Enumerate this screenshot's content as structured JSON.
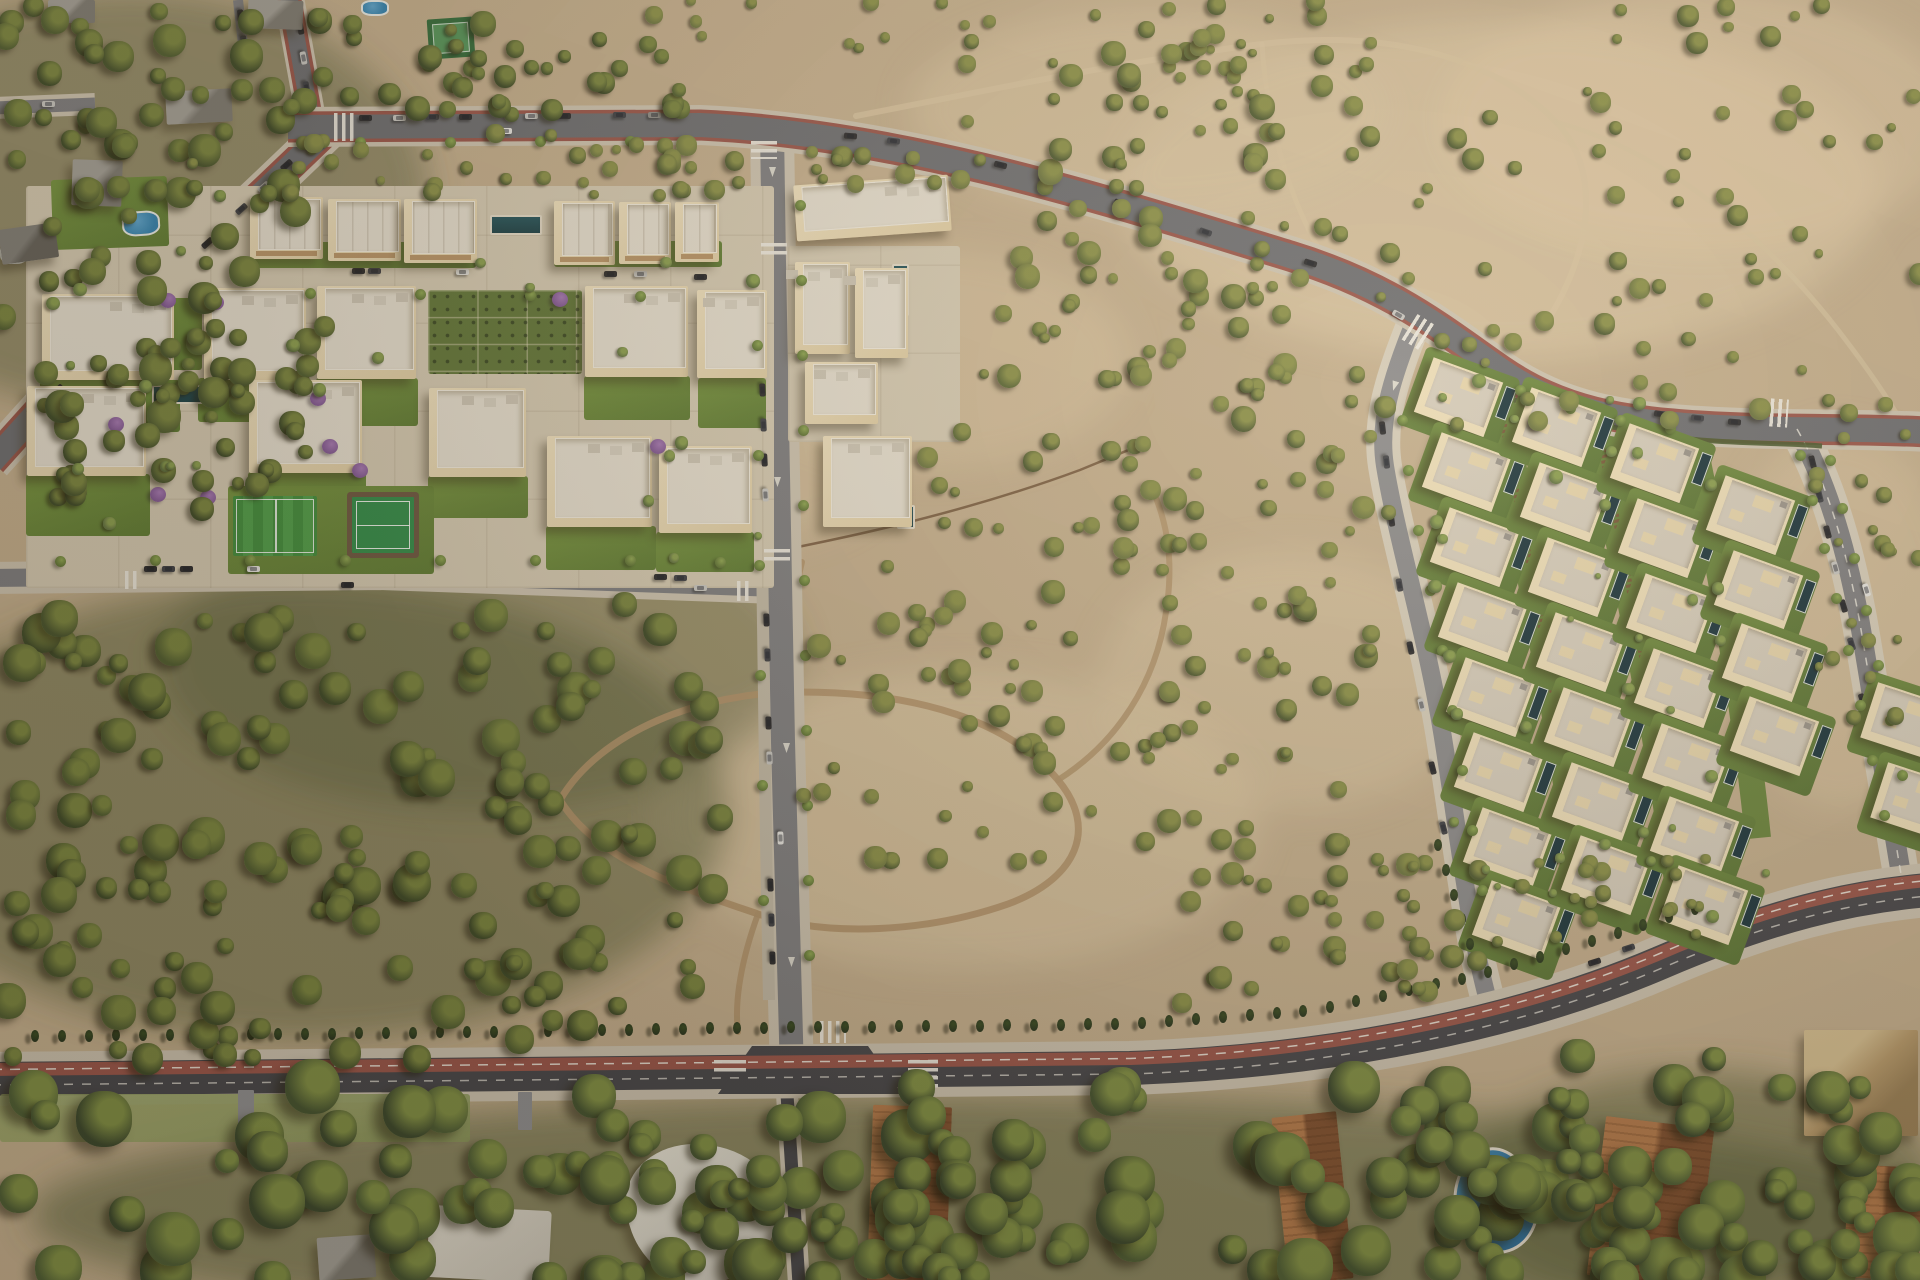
{
  "scene": {
    "width": 1920,
    "height": 1280,
    "seed": 42,
    "description_data": {
      "kind": "aerial-render",
      "content": "residential development masterplan aerial view"
    }
  },
  "palette": {
    "sand": "#c6b190",
    "sandLight": "#dbc7a4",
    "sandPink": "#e3cda9",
    "washDark": "#55603a",
    "asphaltDark": "#43444a",
    "asphaltMid": "#6b6d72",
    "asphaltLight": "#7d7e82",
    "asphaltXLight": "#8a8b8e",
    "sidewalk": "#cfc6b4",
    "sidewalkLight": "#c3bba9",
    "bikeRed": "#9a544a",
    "white": "#f0ede4",
    "roofLight": "#e8e2d4",
    "parapet": "#f4efe2",
    "villaWall": "#f1e2bd",
    "villaRoof": "#d8d0c0",
    "villaPatio": "#ead9b0",
    "pitch1": "#3f8f3d",
    "pitch2": "#4da04a",
    "padel": "#2e8d49",
    "terra1": "#b57a4b",
    "terra2": "#7e4e2e",
    "grayRoof1": "#a3a19a",
    "grayRoof2": "#7d7b74",
    "cypress": "#24331c",
    "jac": "#a678b8",
    "jacDark": "#7e5494",
    "dirt": "#b2946c",
    "trail": "#d9c6a3",
    "fence": "#6b4e33",
    "hedge": "#46582c"
  },
  "carColors": {
    "d": "#26272b",
    "e": "#3a3d44",
    "s": "#c9c9c6",
    "w": "#e9e9e6",
    "g": "#8c8c89"
  },
  "treePalettes": {
    "forest": {
      "base": [
        "#3a4826",
        "#44522b",
        "#4d5c2f"
      ],
      "hl": "#79863f"
    },
    "scrub": {
      "base": [
        "#4c5930",
        "#5a6836",
        "#6b7540"
      ],
      "hl": "#8a9148"
    },
    "lush": {
      "base": [
        "#36452a",
        "#40512e",
        "#4a5c33"
      ],
      "hl": "#7f9044"
    },
    "garden": {
      "base": [
        "#55683a",
        "#617442"
      ],
      "hl": "#8aa04f"
    }
  },
  "legend": {
    "treeRegions": "[x,y,w,h,count,rMin,rMax,palette]",
    "pads": "[type,x,y,w,h,rotDeg]",
    "buildings": "[type,x,y,w,h,rotDeg]",
    "villas": "[centerX,centerY,(rotDeg=20)]",
    "cars": "[centerX,centerY,rotDeg,colorKey]",
    "zebras": "[centerX,centerY,w,h,dir,rotDeg]",
    "arrows": "[x,y,rotDeg]",
    "streetTrees": "[x,y,(diam)]",
    "cypressRows": "{pts:[[x,y]...],sp:spacing}"
  },
  "treeRegions": [
    [
      0,
      0,
      300,
      430,
      80,
      7,
      17,
      "forest"
    ],
    [
      280,
      0,
      420,
      115,
      40,
      6,
      13,
      "forest"
    ],
    [
      55,
      325,
      270,
      185,
      36,
      6,
      14,
      "forest"
    ],
    [
      960,
      50,
      330,
      380,
      75,
      5,
      13,
      "scrub"
    ],
    [
      810,
      150,
      140,
      40,
      10,
      "5",
      "11",
      "scrub"
    ],
    [
      640,
      145,
      100,
      60,
      10,
      5,
      11,
      "scrub"
    ],
    [
      1090,
      0,
      830,
      430,
      110,
      4,
      11,
      "scrub"
    ],
    [
      640,
      0,
      640,
      55,
      20,
      4,
      9,
      "scrub"
    ],
    [
      0,
      598,
      740,
      310,
      110,
      8,
      20,
      "forest"
    ],
    [
      0,
      890,
      700,
      170,
      55,
      8,
      18,
      "forest"
    ],
    [
      800,
      555,
      405,
      310,
      55,
      5,
      12,
      "scrub"
    ],
    [
      1145,
      430,
      245,
      420,
      52,
      5,
      12,
      "scrub"
    ],
    [
      1180,
      858,
      330,
      150,
      40,
      5,
      12,
      "scrub"
    ],
    [
      1510,
      858,
      200,
      80,
      18,
      5,
      10,
      "scrub"
    ],
    [
      0,
      1085,
      1920,
      195,
      120,
      12,
      28,
      "lush"
    ],
    [
      26,
      188,
      744,
      396,
      24,
      4,
      7,
      "garden"
    ],
    [
      1430,
      380,
      340,
      560,
      36,
      3,
      7,
      "garden"
    ],
    [
      600,
      1135,
      420,
      145,
      40,
      10,
      22,
      "lush"
    ],
    [
      1380,
      1055,
      540,
      225,
      60,
      10,
      24,
      "lush"
    ],
    [
      915,
      430,
      290,
      130,
      26,
      5,
      11,
      "scrub"
    ],
    [
      190,
      133,
      520,
      64,
      28,
      4,
      10,
      "scrub"
    ],
    [
      1810,
      430,
      110,
      300,
      20,
      4,
      9,
      "scrub"
    ]
  ],
  "pads": [
    [
      "paving",
      26,
      186,
      748,
      402,
      0
    ],
    [
      "paving",
      788,
      246,
      172,
      196,
      0
    ],
    [
      "lawn",
      250,
      242,
      226,
      26,
      0
    ],
    [
      "lawn",
      554,
      241,
      168,
      26,
      0
    ],
    [
      "lawn",
      40,
      380,
      140,
      52,
      0
    ],
    [
      "lawn",
      198,
      378,
      112,
      44,
      0
    ],
    [
      "lawn",
      316,
      378,
      102,
      48,
      0
    ],
    [
      "lawn",
      584,
      376,
      106,
      44,
      0
    ],
    [
      "lawn",
      26,
      474,
      124,
      62,
      0
    ],
    [
      "lawn",
      248,
      472,
      118,
      58,
      0
    ],
    [
      "lawn",
      428,
      476,
      100,
      42,
      0
    ],
    [
      "lawn",
      546,
      526,
      110,
      44,
      0
    ],
    [
      "lawn",
      656,
      532,
      98,
      40,
      0
    ],
    [
      "lawn",
      698,
      378,
      68,
      50,
      0
    ],
    [
      "lawn",
      118,
      298,
      84,
      72,
      0
    ],
    [
      "lawn",
      228,
      486,
      206,
      88,
      0
    ],
    [
      "garden",
      428,
      290,
      154,
      84,
      0
    ],
    [
      "lawn",
      52,
      178,
      116,
      70,
      -2
    ],
    [
      "lawnpale",
      0,
      1094,
      470,
      48,
      0
    ],
    [
      "drive",
      238,
      1090,
      16,
      42,
      0
    ],
    [
      "drive",
      518,
      1092,
      14,
      38,
      0
    ],
    [
      "pitch",
      233,
      496,
      84,
      60,
      0
    ],
    [
      "padel",
      352,
      497,
      62,
      56,
      0
    ],
    [
      "tennis",
      428,
      18,
      46,
      40,
      -4
    ],
    [
      "pool",
      490,
      215,
      48,
      16,
      0
    ],
    [
      "pool",
      152,
      385,
      62,
      15,
      0
    ],
    [
      "pool",
      472,
      427,
      44,
      17,
      0
    ],
    [
      "pool",
      892,
      264,
      13,
      48,
      0
    ],
    [
      "pool",
      897,
      505,
      14,
      20,
      0
    ],
    [
      "bluepool",
      122,
      211,
      34,
      21,
      -4
    ],
    [
      "bluepool",
      0,
      242,
      24,
      18,
      0
    ],
    [
      "bluepool",
      361,
      0,
      24,
      12,
      0
    ],
    [
      "kidney",
      1452,
      1148,
      80,
      100,
      -18
    ]
  ],
  "buildings": [
    [
      "town",
      250,
      197,
      73,
      62,
      0
    ],
    [
      "town",
      328,
      199,
      73,
      62,
      0
    ],
    [
      "town",
      404,
      199,
      73,
      64,
      0
    ],
    [
      "town",
      554,
      201,
      61,
      64,
      0
    ],
    [
      "town",
      619,
      202,
      52,
      62,
      0
    ],
    [
      "town",
      675,
      202,
      44,
      60,
      0
    ],
    [
      "apt",
      42,
      294,
      132,
      86,
      0
    ],
    [
      "apt",
      204,
      288,
      102,
      92,
      0
    ],
    [
      "apt",
      317,
      286,
      99,
      93,
      0
    ],
    [
      "apt",
      585,
      286,
      103,
      91,
      0
    ],
    [
      "apt",
      697,
      290,
      70,
      88,
      0
    ],
    [
      "apt",
      27,
      386,
      119,
      90,
      0
    ],
    [
      "apt",
      249,
      380,
      113,
      93,
      0
    ],
    [
      "apt",
      429,
      388,
      97,
      89,
      0
    ],
    [
      "apt",
      547,
      436,
      105,
      91,
      0
    ],
    [
      "apt",
      659,
      446,
      93,
      87,
      0
    ],
    [
      "apt",
      795,
      180,
      155,
      56,
      -4
    ],
    [
      "apt",
      795,
      262,
      55,
      92,
      0
    ],
    [
      "apt",
      855,
      268,
      53,
      90,
      0
    ],
    [
      "apt",
      805,
      362,
      73,
      62,
      0
    ],
    [
      "apt",
      823,
      436,
      89,
      91,
      0
    ],
    [
      "gray",
      72,
      160,
      50,
      46,
      2
    ],
    [
      "gray",
      166,
      90,
      66,
      33,
      -3
    ],
    [
      "gray",
      48,
      0,
      47,
      23,
      0
    ],
    [
      "gray",
      248,
      0,
      55,
      29,
      2
    ],
    [
      "grayd",
      0,
      226,
      57,
      35,
      -8
    ],
    [
      "gray",
      318,
      1236,
      57,
      43,
      -4
    ],
    [
      "terra",
      870,
      1106,
      79,
      176,
      2
    ],
    [
      "terra",
      1280,
      1114,
      65,
      168,
      -6
    ],
    [
      "terra",
      1596,
      1122,
      109,
      160,
      7
    ],
    [
      "terra",
      1846,
      1166,
      75,
      113,
      3
    ],
    [
      "hip",
      1804,
      1030,
      114,
      106,
      0
    ],
    [
      "curved",
      626,
      1144,
      152,
      140,
      0
    ],
    [
      "white",
      428,
      1208,
      122,
      72,
      3
    ]
  ],
  "villas": [
    [
      1460,
      402
    ],
    [
      1468,
      477
    ],
    [
      1476,
      552
    ],
    [
      1484,
      627
    ],
    [
      1492,
      702
    ],
    [
      1500,
      777
    ],
    [
      1509,
      852
    ],
    [
      1518,
      925
    ],
    [
      1558,
      432
    ],
    [
      1566,
      507
    ],
    [
      1574,
      582
    ],
    [
      1582,
      657
    ],
    [
      1590,
      732
    ],
    [
      1598,
      807
    ],
    [
      1607,
      880
    ],
    [
      1656,
      468
    ],
    [
      1664,
      543
    ],
    [
      1672,
      618
    ],
    [
      1680,
      693
    ],
    [
      1688,
      768
    ],
    [
      1696,
      841
    ],
    [
      1705,
      910
    ],
    [
      1752,
      520
    ],
    [
      1760,
      595
    ],
    [
      1768,
      668
    ],
    [
      1776,
      741
    ],
    [
      1906,
      726,
      18
    ],
    [
      1916,
      806,
      18
    ]
  ],
  "cars": [
    [
      365,
      118,
      0,
      "d"
    ],
    [
      399,
      118,
      0,
      "s"
    ],
    [
      432,
      117,
      0,
      "e"
    ],
    [
      465,
      117,
      0,
      "d"
    ],
    [
      531,
      116,
      0,
      "s"
    ],
    [
      564,
      116,
      0,
      "d"
    ],
    [
      619,
      115,
      0,
      "e"
    ],
    [
      654,
      115,
      0,
      "g"
    ],
    [
      505,
      131,
      0,
      "w"
    ],
    [
      300,
      28,
      80,
      "d"
    ],
    [
      303,
      58,
      80,
      "s"
    ],
    [
      306,
      88,
      80,
      "e"
    ],
    [
      20,
      104,
      0,
      "w"
    ],
    [
      48,
      104,
      0,
      "s"
    ],
    [
      240,
      16,
      85,
      "d"
    ],
    [
      243,
      42,
      85,
      "e"
    ],
    [
      850,
      136,
      4,
      "d"
    ],
    [
      893,
      141,
      7,
      "e"
    ],
    [
      1000,
      165,
      14,
      "d"
    ],
    [
      1046,
      178,
      15,
      "s"
    ],
    [
      1120,
      203,
      17,
      "d"
    ],
    [
      1205,
      232,
      19,
      "e"
    ],
    [
      1310,
      263,
      17,
      "d"
    ],
    [
      1398,
      315,
      30,
      "s"
    ],
    [
      1660,
      414,
      8,
      "d"
    ],
    [
      1697,
      418,
      6,
      "e"
    ],
    [
      1734,
      422,
      5,
      "d"
    ],
    [
      286,
      165,
      -41,
      "d"
    ],
    [
      263,
      187,
      -41,
      "s"
    ],
    [
      241,
      209,
      -41,
      "e"
    ],
    [
      207,
      243,
      -42,
      "d"
    ],
    [
      140,
      306,
      -42,
      "d"
    ],
    [
      113,
      333,
      -43,
      "w"
    ],
    [
      90,
      356,
      -43,
      "s"
    ],
    [
      57,
      390,
      -44,
      "d"
    ],
    [
      36,
      412,
      -44,
      "e"
    ],
    [
      358,
      271,
      0,
      "d"
    ],
    [
      374,
      271,
      0,
      "e"
    ],
    [
      462,
      272,
      0,
      "w"
    ],
    [
      610,
      274,
      0,
      "d"
    ],
    [
      640,
      274,
      0,
      "s"
    ],
    [
      700,
      277,
      0,
      "d"
    ],
    [
      150,
      569,
      0,
      "d"
    ],
    [
      168,
      569,
      0,
      "e"
    ],
    [
      186,
      569,
      0,
      "d"
    ],
    [
      253,
      569,
      0,
      "w"
    ],
    [
      347,
      585,
      0,
      "d"
    ],
    [
      660,
      577,
      0,
      "d"
    ],
    [
      680,
      578,
      0,
      "e"
    ],
    [
      700,
      588,
      0,
      "s"
    ],
    [
      762,
      390,
      87,
      "d"
    ],
    [
      763,
      425,
      87,
      "e"
    ],
    [
      764,
      460,
      87,
      "d"
    ],
    [
      765,
      495,
      87,
      "s"
    ],
    [
      766,
      620,
      88,
      "d"
    ],
    [
      767,
      655,
      88,
      "e"
    ],
    [
      768,
      723,
      88,
      "d"
    ],
    [
      769,
      758,
      88,
      "s"
    ],
    [
      770,
      885,
      88,
      "d"
    ],
    [
      771,
      920,
      88,
      "e"
    ],
    [
      772,
      958,
      88,
      "d"
    ],
    [
      780,
      838,
      88,
      "w"
    ],
    [
      1382,
      428,
      83,
      "d"
    ],
    [
      1386,
      462,
      83,
      "e"
    ],
    [
      1391,
      520,
      82,
      "d"
    ],
    [
      1399,
      585,
      80,
      "e"
    ],
    [
      1410,
      648,
      78,
      "d"
    ],
    [
      1421,
      705,
      77,
      "s"
    ],
    [
      1432,
      768,
      76,
      "d"
    ],
    [
      1443,
      828,
      75,
      "e"
    ],
    [
      1462,
      922,
      74,
      "w"
    ],
    [
      1812,
      462,
      76,
      "d"
    ],
    [
      1819,
      496,
      76,
      "e"
    ],
    [
      1827,
      532,
      75,
      "d"
    ],
    [
      1835,
      568,
      74,
      "s"
    ],
    [
      1843,
      606,
      74,
      "d"
    ],
    [
      1851,
      644,
      73,
      "e"
    ],
    [
      1862,
      700,
      72,
      "d"
    ],
    [
      1872,
      748,
      72,
      "e"
    ],
    [
      1882,
      796,
      71,
      "d"
    ],
    [
      1866,
      590,
      73,
      "w"
    ],
    [
      1594,
      962,
      -17,
      "d"
    ],
    [
      1628,
      948,
      -18,
      "e"
    ],
    [
      833,
      292,
      0,
      "d"
    ],
    [
      833,
      309,
      0,
      "e"
    ]
  ],
  "zebras": [
    [
      344,
      127,
      20,
      28,
      "v",
      0
    ],
    [
      764,
      150,
      26,
      18,
      "h",
      0
    ],
    [
      774,
      251,
      26,
      16,
      "h",
      0
    ],
    [
      777,
      557,
      26,
      16,
      "h",
      0
    ],
    [
      744,
      591,
      14,
      20,
      "v",
      0
    ],
    [
      132,
      580,
      14,
      18,
      "v",
      0
    ],
    [
      833,
      1032,
      26,
      22,
      "v",
      0
    ],
    [
      730,
      1067,
      32,
      14,
      "h",
      0
    ],
    [
      923,
      1075,
      30,
      30,
      "h",
      0
    ],
    [
      1418,
      332,
      20,
      30,
      "v",
      32
    ],
    [
      1779,
      413,
      18,
      28,
      "v",
      4
    ]
  ],
  "arrows": [
    [
      772,
      172,
      180
    ],
    [
      777,
      482,
      180
    ],
    [
      786,
      748,
      180
    ],
    [
      791,
      962,
      180
    ],
    [
      1394,
      386,
      197
    ]
  ],
  "streetTrees": [
    [
      800,
      205
    ],
    [
      801,
      280
    ],
    [
      802,
      355
    ],
    [
      803,
      430
    ],
    [
      803,
      505
    ],
    [
      804,
      580
    ],
    [
      805,
      655
    ],
    [
      806,
      730
    ],
    [
      807,
      805
    ],
    [
      808,
      880
    ],
    [
      809,
      955
    ],
    [
      757,
      345
    ],
    [
      758,
      455
    ],
    [
      759,
      565
    ],
    [
      760,
      675
    ],
    [
      762,
      785
    ],
    [
      763,
      900
    ],
    [
      60,
      561
    ],
    [
      155,
      560
    ],
    [
      250,
      560
    ],
    [
      345,
      560
    ],
    [
      440,
      560
    ],
    [
      535,
      560
    ],
    [
      630,
      560
    ],
    [
      720,
      562
    ],
    [
      200,
      292
    ],
    [
      310,
      293
    ],
    [
      420,
      294
    ],
    [
      530,
      295
    ],
    [
      640,
      296
    ],
    [
      360,
      142
    ],
    [
      450,
      142
    ],
    [
      540,
      141
    ],
    [
      630,
      141
    ],
    [
      1800,
      455
    ],
    [
      1812,
      500
    ],
    [
      1824,
      548
    ],
    [
      1836,
      598
    ],
    [
      1848,
      650
    ],
    [
      1860,
      705
    ],
    [
      1872,
      760
    ],
    [
      1884,
      815
    ],
    [
      1830,
      460
    ],
    [
      1842,
      508
    ],
    [
      1854,
      558
    ],
    [
      1866,
      610
    ],
    [
      1878,
      665
    ],
    [
      1890,
      720
    ],
    [
      1902,
      775
    ],
    [
      1402,
      420
    ],
    [
      1408,
      470
    ],
    [
      1418,
      530
    ],
    [
      1430,
      590
    ],
    [
      1442,
      650
    ],
    [
      1452,
      710
    ],
    [
      1462,
      770
    ],
    [
      1472,
      830
    ],
    [
      1482,
      890
    ],
    [
      1520,
      390
    ],
    [
      1570,
      408
    ],
    [
      1620,
      420
    ],
    [
      1670,
      428
    ]
  ],
  "jacarandas": [
    [
      168,
      300
    ],
    [
      216,
      302
    ],
    [
      318,
      398
    ],
    [
      360,
      470
    ],
    [
      158,
      494
    ],
    [
      208,
      497
    ],
    [
      560,
      299
    ],
    [
      658,
      446
    ],
    [
      116,
      424
    ],
    [
      330,
      446
    ]
  ],
  "cypressRows": [
    {
      "pts": [
        [
          35,
          1036
        ],
        [
          400,
          1033
        ],
        [
          740,
          1028
        ],
        [
          1130,
          1024
        ],
        [
          1310,
          1011
        ],
        [
          1470,
          977
        ],
        [
          1600,
          939
        ],
        [
          1706,
          905
        ]
      ],
      "sp": 27
    },
    {
      "pts": [
        [
          1438,
          845
        ],
        [
          1456,
          902
        ],
        [
          1474,
          958
        ]
      ],
      "sp": 26
    }
  ]
}
